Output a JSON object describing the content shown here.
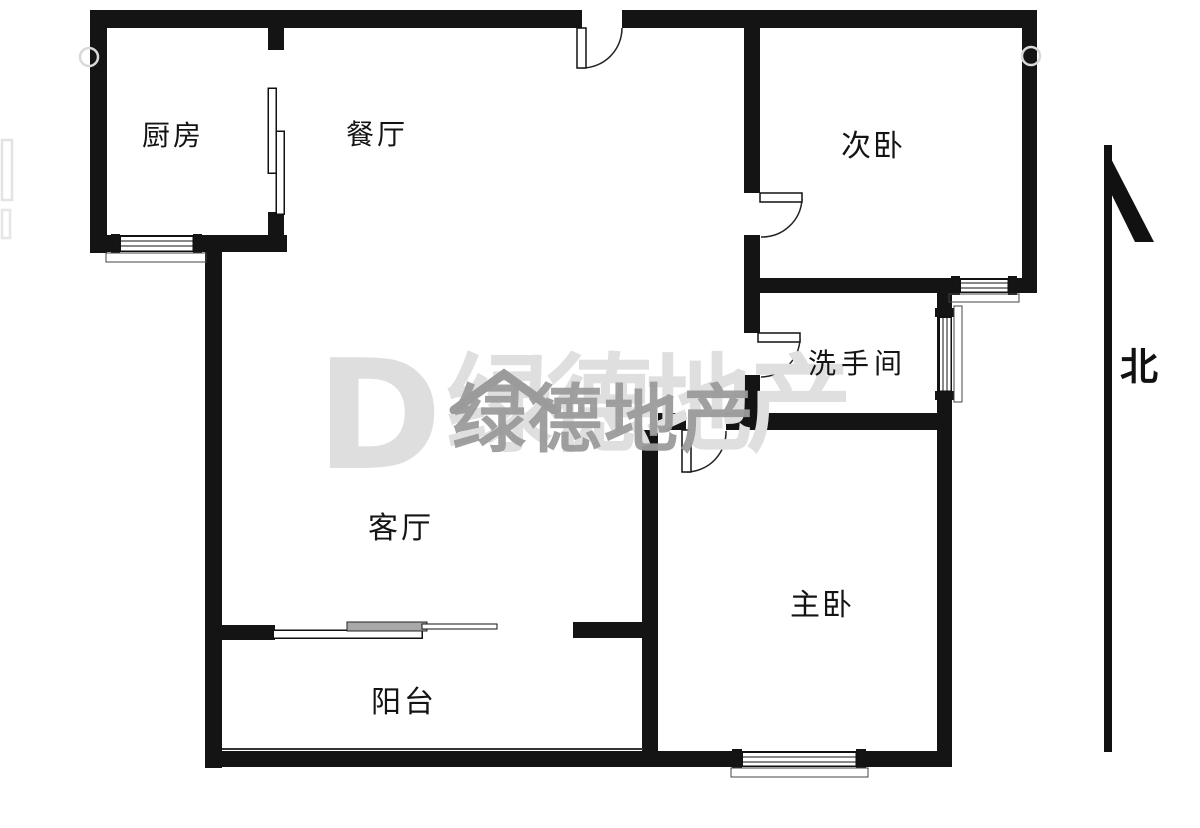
{
  "plan": {
    "type": "apartment-floor-plan",
    "wall_color": "#141414",
    "background": "#ffffff",
    "rooms": {
      "kitchen": {
        "label": "厨房"
      },
      "dining": {
        "label": "餐厅"
      },
      "second_bedroom": {
        "label": "次卧"
      },
      "bathroom": {
        "label": "洗手间"
      },
      "living_room": {
        "label": "客厅"
      },
      "master_bedroom": {
        "label": "主卧"
      },
      "balcony": {
        "label": "阳台"
      }
    },
    "fixtures": {
      "doors": [
        "entry-door",
        "second-bedroom-door",
        "bathroom-door",
        "master-bedroom-door"
      ],
      "sliding_doors": [
        "kitchen-sliding-door",
        "balcony-sliding-door"
      ],
      "windows": [
        "kitchen-window",
        "second-bedroom-window",
        "bathroom-window",
        "master-bedroom-window"
      ]
    }
  },
  "compass": {
    "north_label": "北",
    "style": "staff-with-blade-arrow"
  },
  "watermark": {
    "logo_letter": "D",
    "brand_text_light": "绿德地产",
    "brand_text_dark": "绿德地产",
    "roof_icon": "house-roof",
    "color_light": "#dfdfdf",
    "color_dark": "#9b9b9b"
  }
}
